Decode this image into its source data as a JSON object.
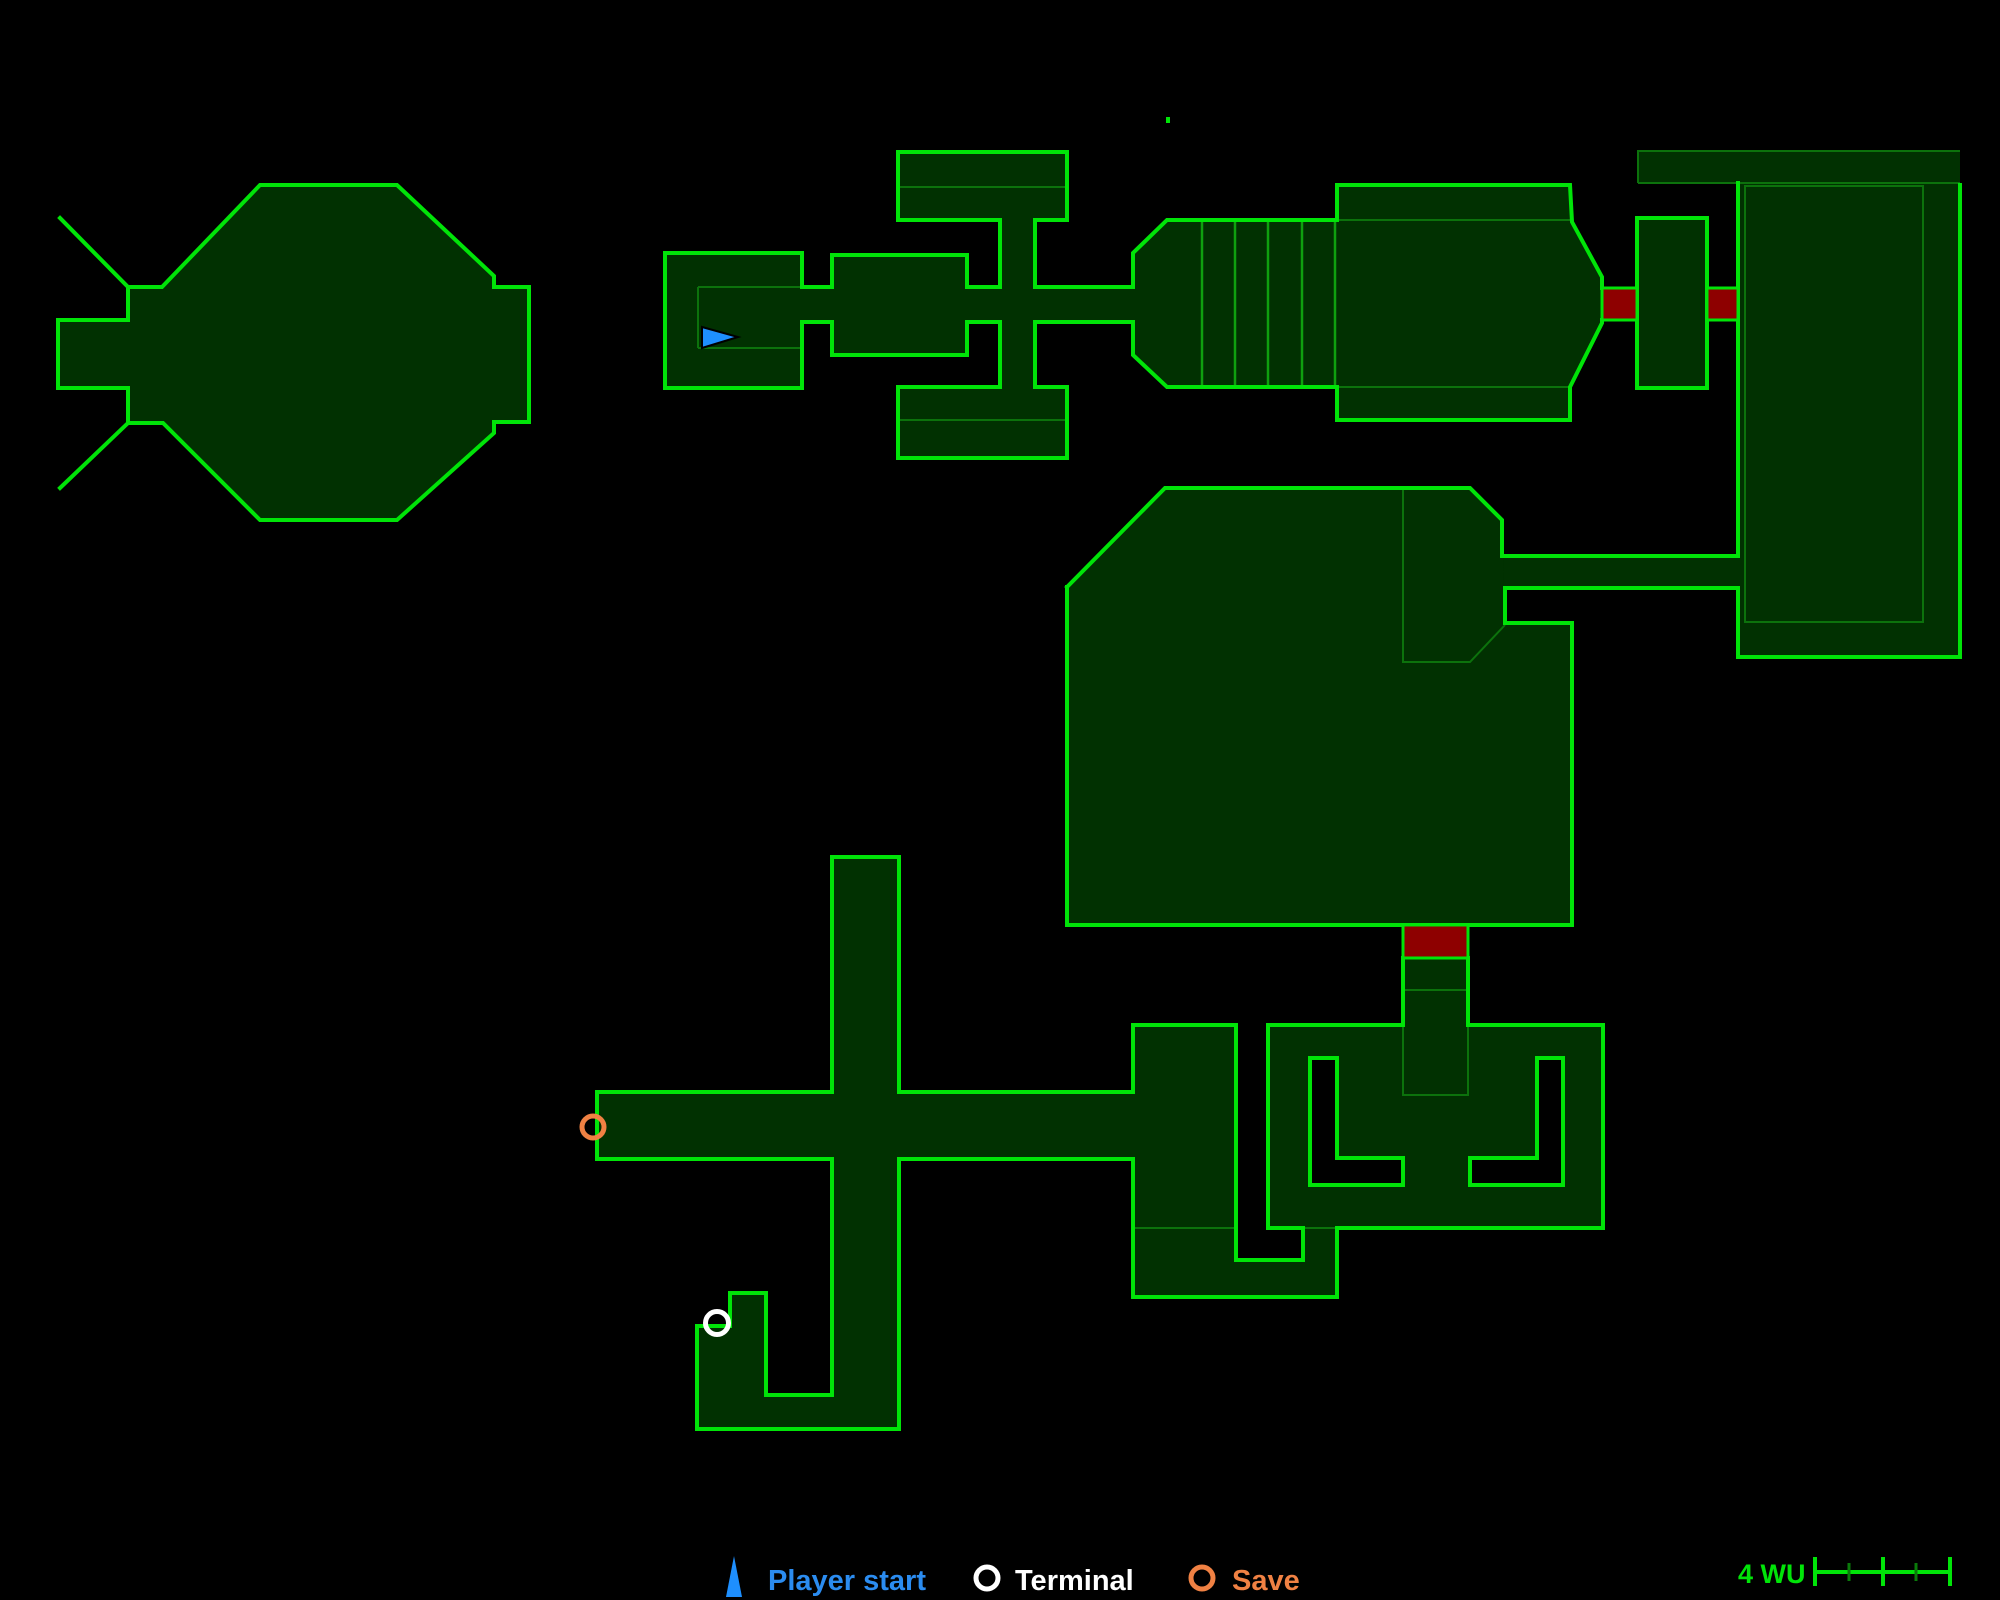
{
  "colors": {
    "bg": "#000000",
    "room_fill": "#013101",
    "bright": "#00e408",
    "thin": "#0c720c",
    "medium": "#0fa00f",
    "door_red": "#8e0000",
    "marker_blue": "#1e8ffe",
    "legend_blue": "#2b8cf0",
    "white": "#ffffff",
    "orange": "#f08143",
    "dim_tick": "#0a7a0a"
  },
  "legend": {
    "player_start_label": "Player start",
    "terminal_label": "Terminal",
    "save_label": "Save",
    "icons": {
      "player_start_points": "734,1556 742,1597 726,1597",
      "terminal": {
        "cx": 987,
        "cy": 1578,
        "r": 11
      },
      "save": {
        "cx": 1202,
        "cy": 1578,
        "r": 11
      }
    }
  },
  "scale_bar": {
    "label": "4 WU",
    "ruler": {
      "line": "M1815,1572 L1952,1572",
      "big_ticks": "M1815,1557 L1815,1586 M1883,1557 L1883,1586 M1950,1557 L1950,1586",
      "small_ticks": "M1849,1563 L1849,1581 M1916,1563 L1916,1581"
    }
  },
  "map": {
    "rooms": [
      {
        "name": "octagon-room",
        "d": "M260,185 L397,185 L494,276 L494,287 L529,287 L529,422 L494,422 L494,433 L397,520 L260,520 L163,423 L128,423 L128,388 L58,388 L58,320 L128,320 L128,287 L162,287 Z"
      },
      {
        "name": "start-room",
        "d": "M665,253 L802,253 L802,388 L665,388 Z"
      },
      {
        "name": "corridor-start",
        "d": "M802,287 L832,287 L832,322 L802,322 Z"
      },
      {
        "name": "mid-room",
        "d": "M832,255 L967,255 L967,355 L832,355 Z"
      },
      {
        "name": "corridor-mid",
        "d": "M967,287 L1000,287 L1000,322 L967,322 Z"
      },
      {
        "name": "cross-top-bar",
        "d": "M898,152 L1067,152 L1067,220 L898,220 Z"
      },
      {
        "name": "cross-vertical",
        "d": "M1000,220 L1035,220 L1035,387 L1000,387 Z"
      },
      {
        "name": "cross-bottom-bar",
        "d": "M898,387 L1067,387 L1067,458 L898,458 Z"
      },
      {
        "name": "corridor-to-engine",
        "d": "M1035,287 L1133,287 L1133,322 L1035,322 Z"
      },
      {
        "name": "engine-room",
        "d": "M1133,253 L1167,220 L1337,220 L1337,185 L1570,185 L1572,222 L1602,277 L1602,323 L1572,383 L1570,387 L1570,420 L1337,420 L1337,387 L1167,387 L1133,355 Z"
      },
      {
        "name": "airlock-room",
        "d": "M1637,218 L1707,218 L1707,388 L1637,388 Z"
      },
      {
        "name": "tall-right-room",
        "d": "M1638,151 L1960,151 L1960,657 L1738,657 L1738,183 L1638,183 Z"
      },
      {
        "name": "corridor-poly-tall",
        "d": "M1502,556 L1738,556 L1738,588 L1502,588 Z"
      },
      {
        "name": "big-hall",
        "d": "M1165,488 L1470,488 L1502,520 L1505,623 L1572,623 L1572,925 L1067,925 L1067,587 Z"
      },
      {
        "name": "shaft-below-door",
        "d": "M1403,958 L1468,958 L1468,1025 L1403,1025 Z"
      },
      {
        "name": "claw-room",
        "d": "M1268,1025 L1603,1025 L1603,1228 L1268,1228 Z"
      },
      {
        "name": "lower-left-block",
        "d": "M1133,1025 L1236,1025 L1236,1260 L1303,1260 L1303,1228 L1337,1228 L1337,1297 L1133,1297 Z"
      },
      {
        "name": "vertical-corridor",
        "d": "M832,857 L899,857 L899,1429 L832,1429 Z"
      },
      {
        "name": "hook-room",
        "d": "M832,1395 L766,1395 L766,1293 L730,1293 L730,1326 L697,1326 L697,1429 L832,1429 Z"
      },
      {
        "name": "horizontal-corridor",
        "d": "M597,1092 L1133,1092 L1133,1159 L597,1159 Z"
      }
    ],
    "bright_lines": [
      {
        "name": "octagon-outline",
        "d": "M260,185 L397,185 L494,276 L494,287 L529,287 L529,422 L494,422 L494,433 L397,520 L260,520 L163,423 L128,423 L128,388 L58,388 L58,320 L128,320 L128,287 L162,287 Z"
      },
      {
        "name": "octagon-antenna-top",
        "d": "M128,287 L60,218"
      },
      {
        "name": "octagon-antenna-bottom",
        "d": "M128,423 L60,488"
      },
      {
        "name": "start-room-outline",
        "d": "M802,287 L802,253 L665,253 L665,388 L802,388 L802,322"
      },
      {
        "name": "corridor-start-walls",
        "d": "M802,287 L832,287 M802,322 L832,322"
      },
      {
        "name": "mid-room-outline",
        "d": "M832,287 L832,255 L967,255 L967,287 M967,322 L967,355 L832,355 L832,322"
      },
      {
        "name": "corridor-mid-walls",
        "d": "M967,287 L1000,287 M967,322 L1000,322"
      },
      {
        "name": "cross-top-bar-outline",
        "d": "M1000,220 L898,220 L898,152 L1067,152 L1067,220 L1035,220"
      },
      {
        "name": "cross-shaft-upper-walls",
        "d": "M1000,220 L1000,287 M1035,220 L1035,287"
      },
      {
        "name": "corridor-engine-walls",
        "d": "M1035,287 L1133,287 M1035,322 L1133,322"
      },
      {
        "name": "cross-shaft-lower-walls",
        "d": "M1000,322 L1000,387 M1035,322 L1035,387"
      },
      {
        "name": "cross-bottom-bar-outline",
        "d": "M1000,387 L898,387 L898,458 L1067,458 L1067,387 L1035,387"
      },
      {
        "name": "engine-outline-upper",
        "d": "M1133,287 L1133,253 L1167,220 L1337,220 L1337,185 L1570,185 L1572,222 L1602,277 L1602,288"
      },
      {
        "name": "engine-outline-lower",
        "d": "M1602,320 L1602,323 L1572,383 L1570,387 L1570,420 L1337,420 L1337,387 L1167,387 L1133,355 L1133,322"
      },
      {
        "name": "airlock-outline",
        "d": "M1637,218 L1707,218 L1707,388 L1637,388 Z"
      },
      {
        "name": "tall-room-outline",
        "d": "M1960,185 L1960,657 L1738,657 L1738,588 M1738,556 L1738,183"
      },
      {
        "name": "corridor-poly-tall-walls",
        "d": "M1502,556 L1738,556 M1505,588 L1738,588"
      },
      {
        "name": "big-hall-outline-top",
        "d": "M1067,587 L1165,488 L1470,488 L1502,520 L1502,556"
      },
      {
        "name": "big-hall-outline-main",
        "d": "M1505,588 L1505,623 L1572,623 L1572,925 L1067,925 L1067,587"
      },
      {
        "name": "shaft-walls",
        "d": "M1403,958 L1403,1025 M1468,958 L1468,1025"
      },
      {
        "name": "claw-room-outline-left",
        "d": "M1403,1025 L1268,1025 L1268,1228 L1303,1228"
      },
      {
        "name": "claw-room-outline-right",
        "d": "M1337,1228 L1603,1228 L1603,1025 L1468,1025"
      },
      {
        "name": "lower-left-outline-a",
        "d": "M1133,1092 L1133,1025 L1236,1025 L1236,1260 L1303,1260 L1303,1228"
      },
      {
        "name": "lower-left-outline-b",
        "d": "M1337,1228 L1337,1297 L1133,1297 L1133,1159"
      },
      {
        "name": "vertical-corridor-upper-walls",
        "d": "M832,1092 L832,857 L899,857 L899,1092"
      },
      {
        "name": "hook-outline",
        "d": "M832,1159 L832,1395 L766,1395 L766,1293 L730,1293 L730,1326 L697,1326 L697,1429 L899,1429 L899,1159"
      },
      {
        "name": "horizontal-corridor-walls",
        "d": "M597,1092 L832,1092 M899,1092 L1133,1092 M597,1159 L832,1159 M899,1159 L1133,1159 M597,1092 L597,1159"
      }
    ],
    "thin_lines": [
      {
        "name": "start-room-inner-walls",
        "d": "M698,287 L802,287 M698,348 L802,348 M698,287 L698,348"
      },
      {
        "name": "cross-top-bar-divider",
        "d": "M898,187 L1067,187"
      },
      {
        "name": "cross-bottom-bar-divider",
        "d": "M898,420 L1067,420"
      },
      {
        "name": "engine-strip-dividers",
        "d": "M1337,220 L1570,220 M1337,387 L1570,387"
      },
      {
        "name": "tall-room-top-strip",
        "d": "M1638,183 L1638,151 L1960,151 M1638,183 L1960,183"
      },
      {
        "name": "tall-room-inner-rect",
        "d": "M1745,186 L1923,186 L1923,622 L1745,622 Z"
      },
      {
        "name": "big-hall-pentagon-divider",
        "d": "M1403,488 L1403,662 L1470,662 L1505,625"
      },
      {
        "name": "shaft-divider",
        "d": "M1403,990 L1468,990"
      },
      {
        "name": "shaft-footprint",
        "d": "M1403,1025 L1403,1095 L1468,1095 L1468,1025"
      },
      {
        "name": "lower-left-dividers",
        "d": "M1133,1228 L1236,1228 M1303,1228 L1337,1228"
      }
    ],
    "medium_lines": [
      {
        "name": "engine-rib-dividers",
        "d": "M1202,220 L1202,387 M1235,220 L1235,387 M1268,220 L1268,387 M1302,220 L1302,387 M1335,220 L1335,387"
      }
    ],
    "doors": [
      {
        "name": "door-engine-airlock",
        "d": "M1602,288 L1637,288 L1637,320 L1602,320 Z"
      },
      {
        "name": "door-airlock-tall",
        "d": "M1707,288 L1738,288 L1738,320 L1707,320 Z"
      },
      {
        "name": "door-hall-shaft",
        "d": "M1403,925 L1468,925 L1468,958 L1403,958 Z"
      }
    ],
    "cutouts": [
      {
        "name": "claw-bracket-left",
        "d": "M1310,1058 L1337,1058 L1337,1158 L1403,1158 L1403,1185 L1310,1185 Z"
      },
      {
        "name": "claw-bracket-right",
        "d": "M1563,1058 L1537,1058 L1537,1158 L1470,1158 L1470,1185 L1563,1185 Z"
      }
    ],
    "markers": {
      "player_start_points": "702,327 738,337 702,348",
      "terminal": {
        "cx": 717,
        "cy": 1323,
        "r": 11.5
      },
      "save": {
        "cx": 593,
        "cy": 1127,
        "r": 11
      },
      "speck": {
        "x": 1166,
        "y": 117,
        "w": 4,
        "h": 6
      }
    }
  }
}
